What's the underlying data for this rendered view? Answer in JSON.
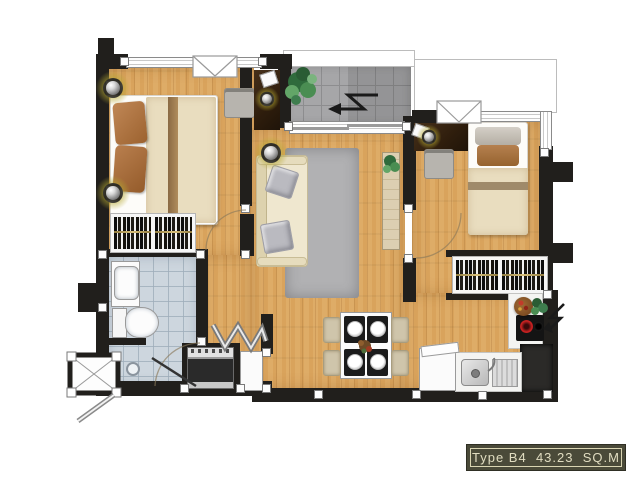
{
  "unit_label": {
    "type": "Type B4",
    "area": "43.23",
    "unit": "SQ.M",
    "full": "Type B4 43.23 SQ.M"
  },
  "palette": {
    "wood_floor": "#d9a35c",
    "wall": "#211f1c",
    "balcony_tile": "#a6a6a8",
    "bathroom_tile": "#cdd6de",
    "rug": "#b1b1b3",
    "sofa_cream": "#efe7cf",
    "pillow_brown": "#b0744a",
    "label_bg": "#4a4a39",
    "label_text": "#e0dcc0",
    "downlight_glow": "#b5a832",
    "hob_burner_red": "#cc2222",
    "plant_green": "#3e7d4e"
  },
  "symbols": {
    "double_bed": "double-bed-icon",
    "single_bed": "single-bed-icon",
    "sofa": "sofa-icon",
    "dining_table": "dining-table-icon",
    "wardrobe": "wardrobe-hangers-icon",
    "toilet": "toilet-icon",
    "washbasin": "washbasin-icon",
    "shower_drain": "shower-drain-icon",
    "oven": "oven-icon",
    "fridge": "fridge-icon",
    "kitchen_sink": "kitchen-sink-icon",
    "hob": "cooktop-icon",
    "downlight": "downlight-icon",
    "plant": "plant-icon",
    "direction_arrow": "zigzag-arrow-icon",
    "folding_door": "folding-door-icon",
    "ac_ledge": "ac-ledge-icon"
  }
}
